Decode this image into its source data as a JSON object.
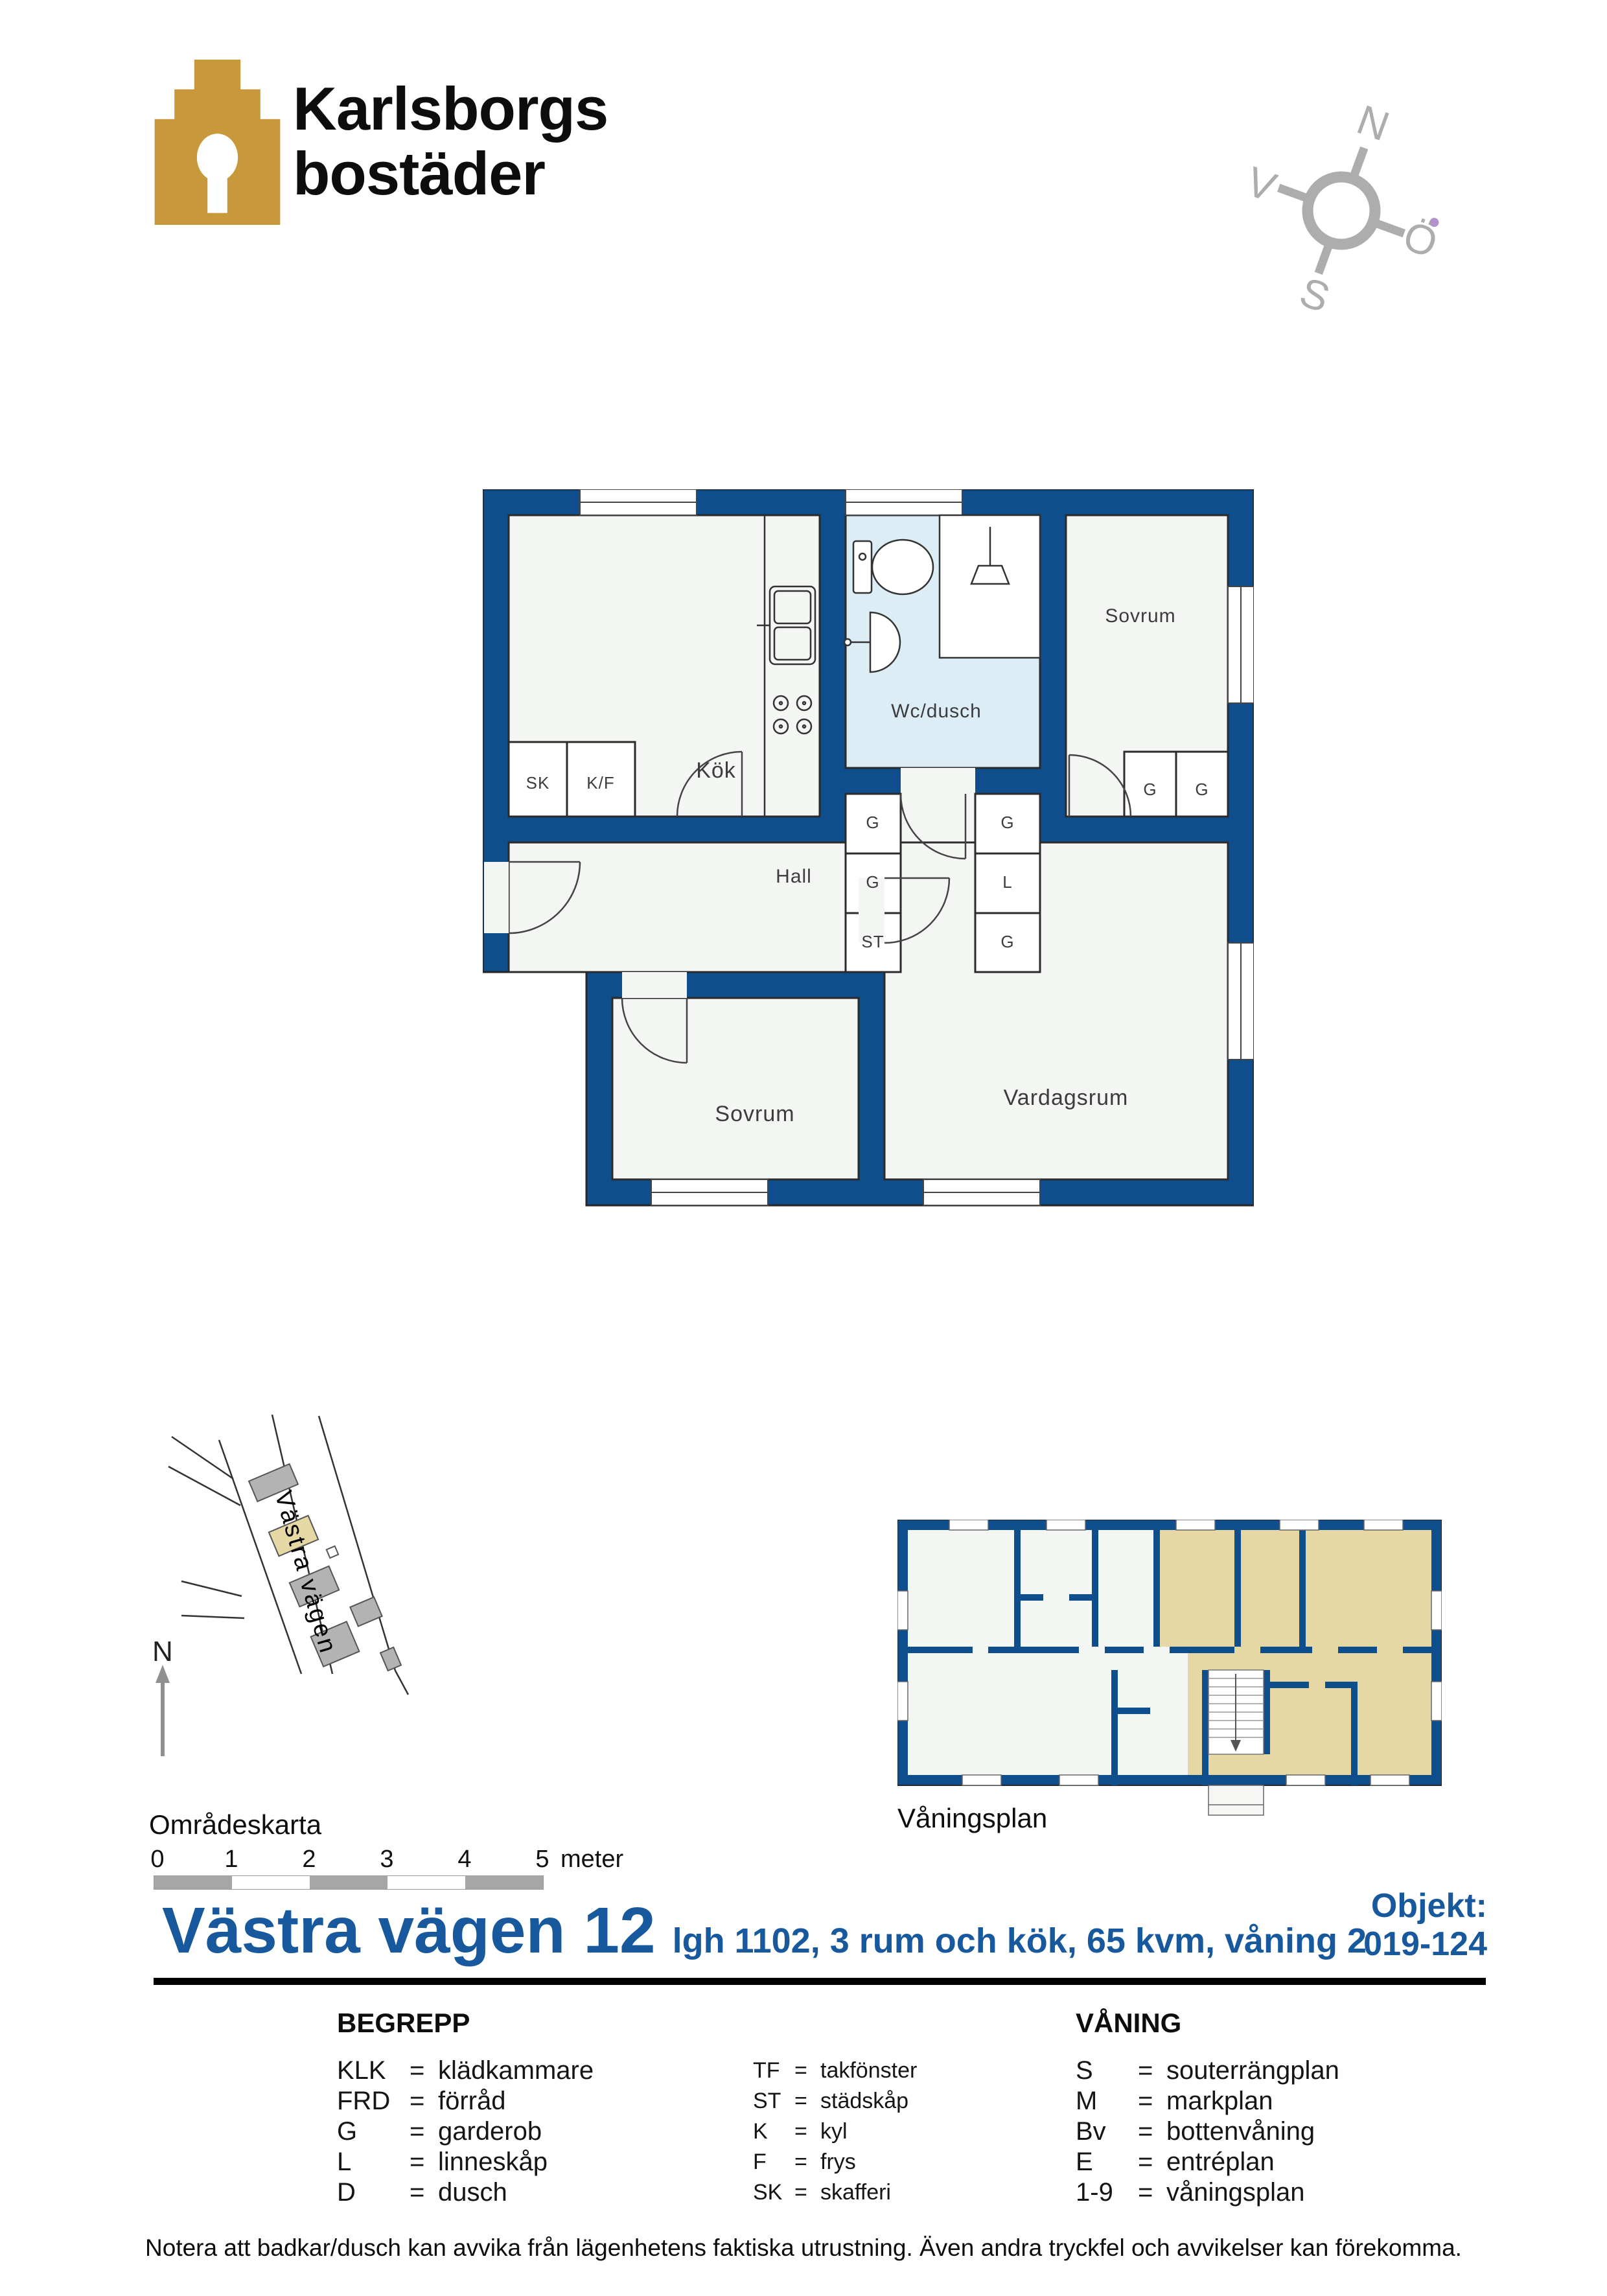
{
  "branding": {
    "name_line1": "Karlsborgs",
    "name_line2": "bostäder"
  },
  "compass": {
    "north": "N",
    "east": "Ö",
    "south": "S",
    "west": "V"
  },
  "plan": {
    "rooms": {
      "kitchen": "Kök",
      "bath": "Wc/dusch",
      "bedroom1": "Sovrum",
      "hall": "Hall",
      "bedroom2": "Sovrum",
      "living": "Vardagsrum"
    },
    "closets": {
      "sk": "SK",
      "kf": "K/F",
      "g": "G",
      "l": "L",
      "st": "ST"
    }
  },
  "area_map": {
    "street": "Västra vägen",
    "north": "N",
    "caption": "Områdeskarta"
  },
  "floor_overview": {
    "caption": "Våningsplan"
  },
  "scale_bar": {
    "ticks": [
      "0",
      "1",
      "2",
      "3",
      "4",
      "5"
    ],
    "unit": "meter"
  },
  "title": {
    "address": "Västra vägen 12",
    "details": "lgh 1102,  3 rum och kök, 65 kvm, våning 2",
    "object_label": "Objekt:",
    "object_number": "019-124"
  },
  "legend": {
    "eq": "=",
    "concepts_header": "BEGREPP",
    "floors_header": "VÅNING",
    "concepts_col1": [
      [
        "KLK",
        "klädkammare"
      ],
      [
        "FRD",
        "förråd"
      ],
      [
        "G",
        "garderob"
      ],
      [
        "L",
        "linneskåp"
      ],
      [
        "D",
        "dusch"
      ]
    ],
    "concepts_col2": [
      [
        "TF",
        "takfönster"
      ],
      [
        "ST",
        "städskåp"
      ],
      [
        "K",
        "kyl"
      ],
      [
        "F",
        "frys"
      ],
      [
        "SK",
        "skafferi"
      ]
    ],
    "floors": [
      [
        "S",
        "souterrängplan"
      ],
      [
        "M",
        "markplan"
      ],
      [
        "Bv",
        "bottenvåning"
      ],
      [
        "E",
        "entréplan"
      ],
      [
        "1-9",
        "våningsplan"
      ]
    ]
  },
  "footer": {
    "note": "Notera att badkar/dusch kan avvika från lägenhetens faktiska utrustning. Även andra tryckfel och avvikelser kan förekomma."
  },
  "colors": {
    "wall_blue": "#0F4E8C",
    "title_blue": "#17599C",
    "logo_gold": "#C7993B",
    "bath_floor": "#DCEDF6",
    "room_floor": "#F4F6F3",
    "highlight_tan": "#E5D8A4",
    "map_building_gray": "#B3B3B3",
    "compass_gray": "#ADADAD",
    "scale_gray": "#A6A6A6"
  }
}
